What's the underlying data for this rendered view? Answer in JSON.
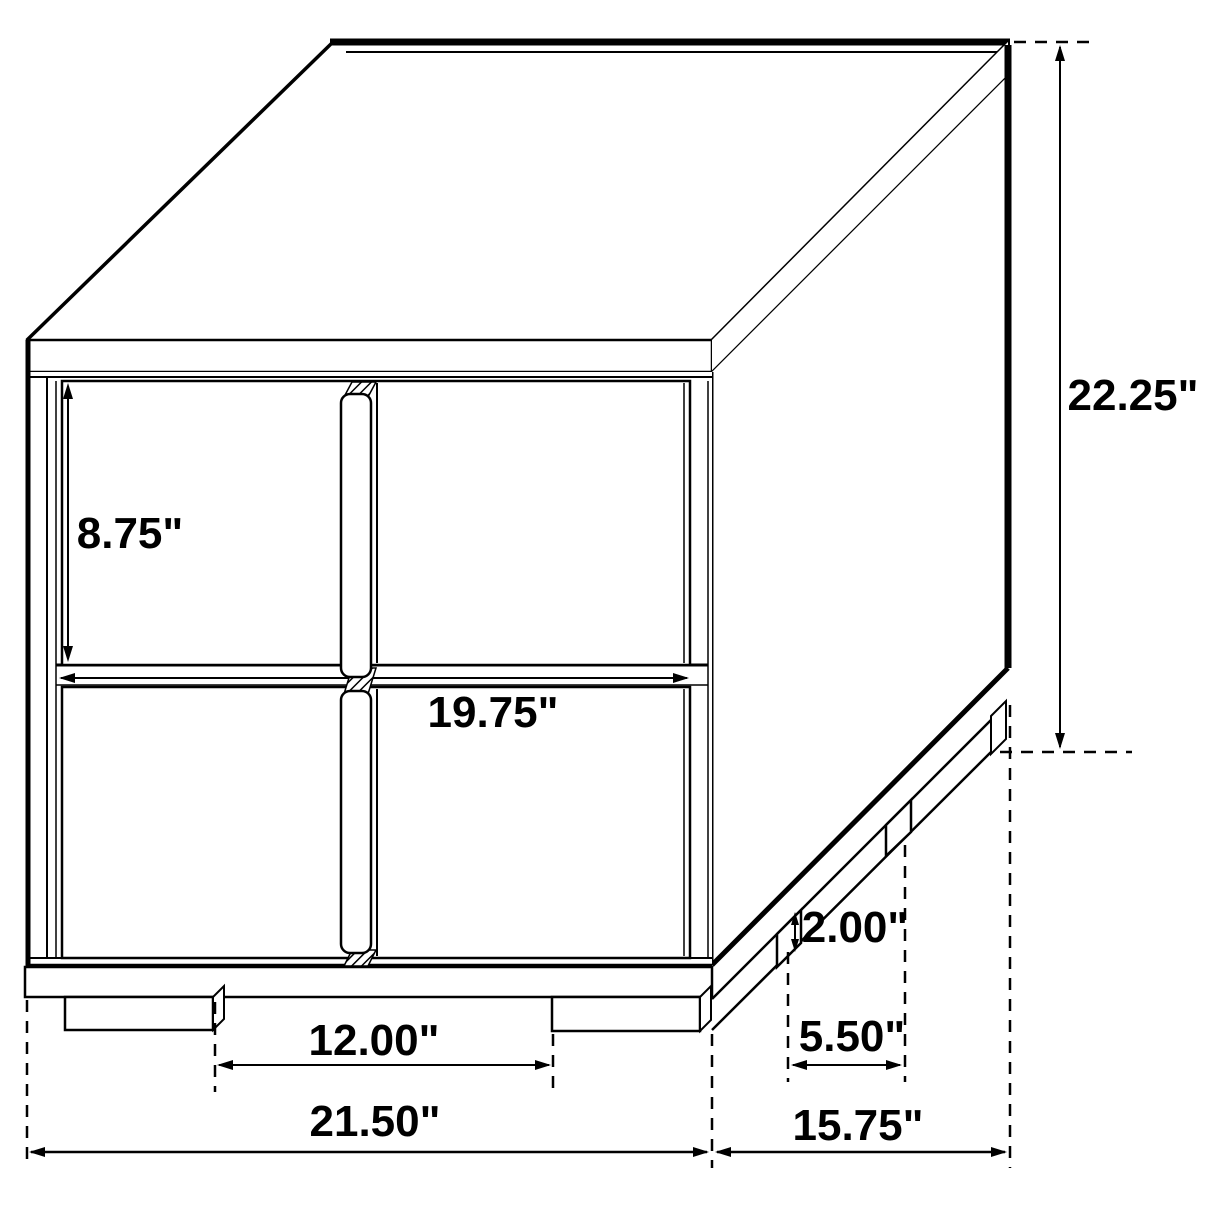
{
  "diagram": {
    "type": "furniture-dimension-line-drawing",
    "subject": "two-drawer nightstand isometric outline",
    "unit": "inches",
    "colors": {
      "line": "#000000",
      "background": "#ffffff"
    },
    "dimensions": {
      "drawer_height": "8.75\"",
      "overall_height": "22.25\"",
      "drawer_width": "19.75\"",
      "front_leg_gap": "12.00\"",
      "overall_width": "21.50\"",
      "leg_height": "2.00\"",
      "side_leg_gap": "5.50\"",
      "overall_depth": "15.75\""
    }
  }
}
